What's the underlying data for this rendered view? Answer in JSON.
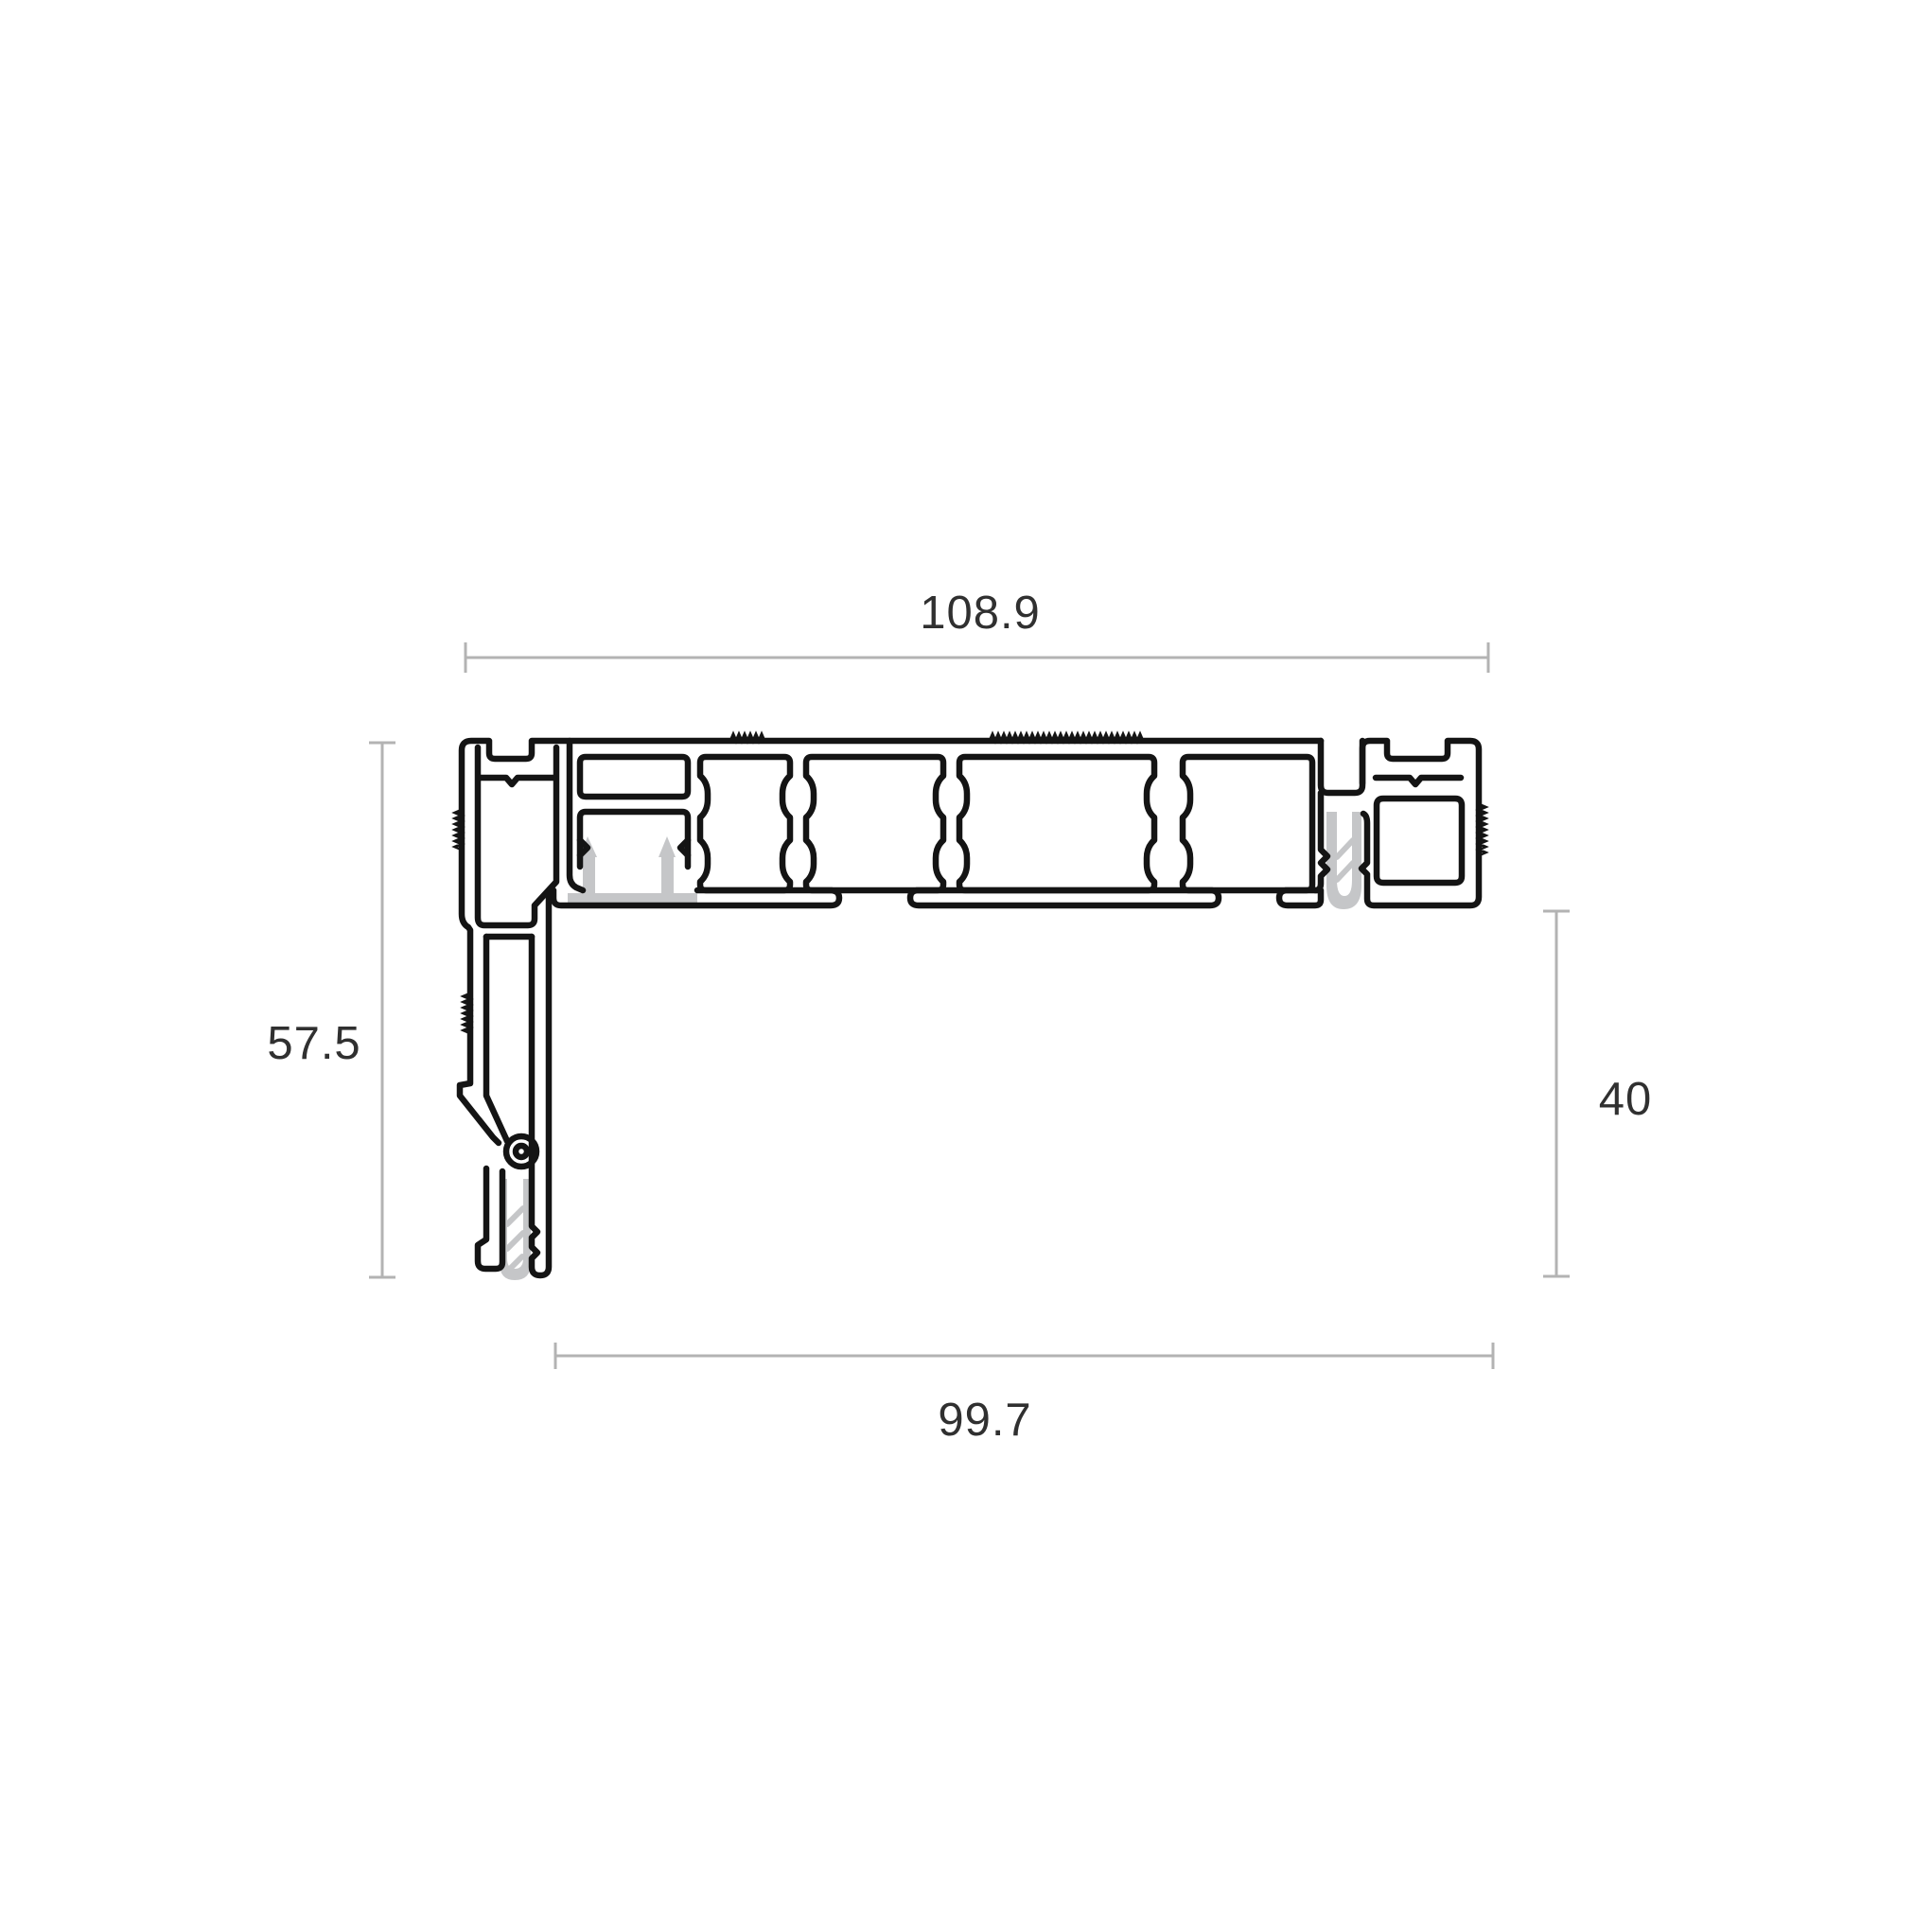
{
  "figure": {
    "type": "aluminium-profile-cross-section",
    "dimensions": {
      "top": {
        "value": "108.9"
      },
      "left": {
        "value": "57.5"
      },
      "right": {
        "value": "40"
      },
      "bottom": {
        "value": "99.7"
      }
    },
    "colors": {
      "outline": "#141414",
      "gasket": "#c5c6c8",
      "gasket_core": "#ffffff",
      "dimension_line": "#b3b3b3",
      "label_text": "#303030",
      "background": "#ffffff"
    }
  }
}
